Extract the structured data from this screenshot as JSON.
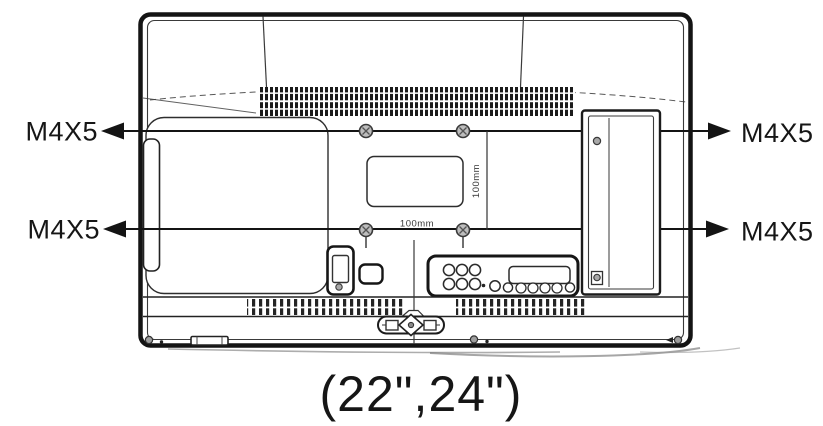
{
  "figure": {
    "type": "tv-rear-vesa-mount-diagram",
    "caption": "(22\",24\")",
    "labels": {
      "top_left": "M4X5",
      "top_right": "M4X5",
      "bottom_left": "M4X5",
      "bottom_right": "M4X5"
    },
    "dimensions": {
      "width": "100mm",
      "height": "100mm"
    },
    "colors": {
      "line": "#1a1a1a",
      "thin_line": "#333333",
      "screw_fill": "#bdbdbd",
      "background": "#ffffff"
    }
  }
}
